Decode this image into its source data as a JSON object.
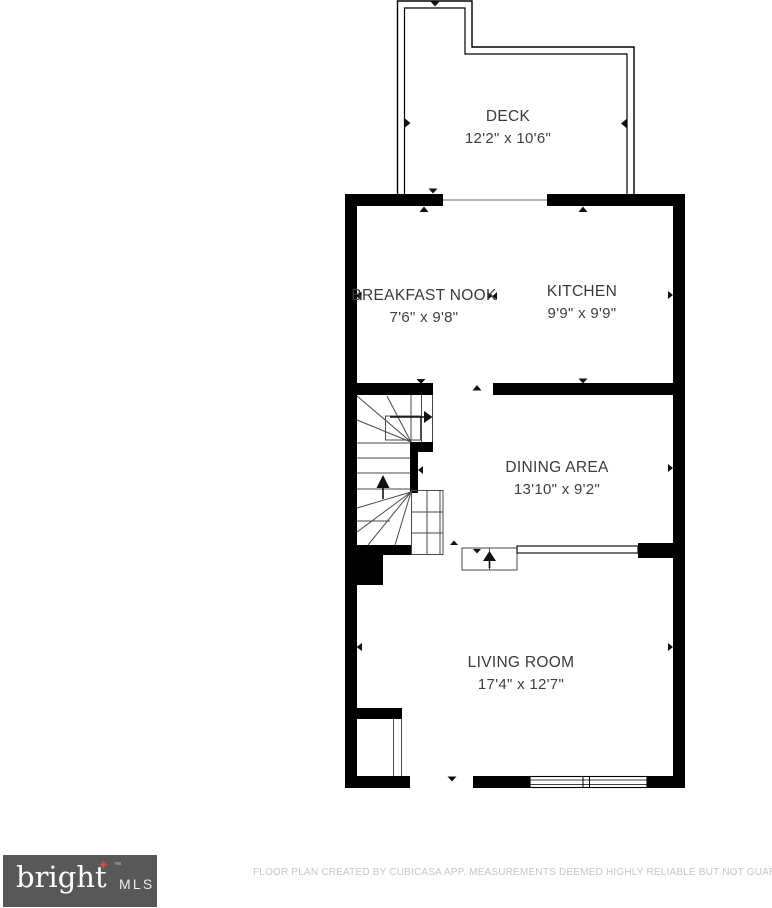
{
  "plan": {
    "rooms": [
      {
        "name": "DECK",
        "dims": "12'2\" x 10'6\""
      },
      {
        "name": "BREAKFAST NOOK",
        "dims": "7'6\" x 9'8\""
      },
      {
        "name": "KITCHEN",
        "dims": "9'9\" x 9'9\""
      },
      {
        "name": "DINING AREA",
        "dims": "13'10\" x 9'2\""
      },
      {
        "name": "LIVING ROOM",
        "dims": "17'4\" x 12'7\""
      }
    ]
  },
  "branding": {
    "logo_word": "bright",
    "logo_star": "✦",
    "logo_tm": "™",
    "logo_suffix": "MLS",
    "logo_bg": "#58585a",
    "star_color": "#c8503c"
  },
  "footer": {
    "disclaimer": "FLOOR PLAN CREATED BY CUBICASA APP. MEASUREMENTS DEEMED HIGHLY RELIABLE BUT NOT GUARANTEED."
  },
  "colors": {
    "wall": "#000000",
    "thin_line": "#4a4a4a",
    "label_text": "#3a3a3a",
    "footer_text": "#c6c6c6"
  }
}
